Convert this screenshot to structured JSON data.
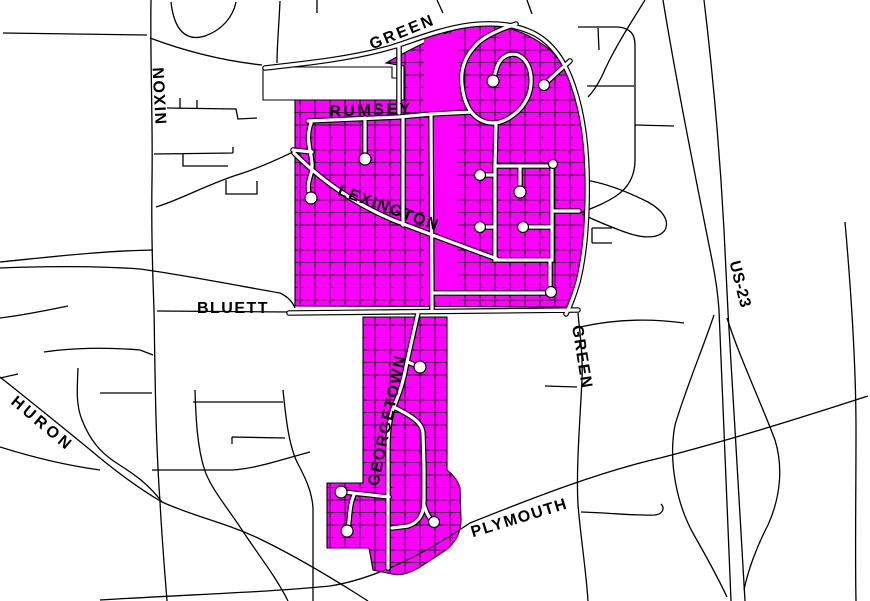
{
  "map": {
    "background_color": "#FFFFFF",
    "road_color": "#000000",
    "highlight_color": "#FF00FF",
    "street_fill_color": "#FFFFFF",
    "labels": [
      {
        "id": "green-top",
        "text": "GREEN"
      },
      {
        "id": "rumsey",
        "text": "RUMSEY"
      },
      {
        "id": "lexington",
        "text": "LEXINGTON"
      },
      {
        "id": "nixon",
        "text": "NIXON"
      },
      {
        "id": "bluett",
        "text": "BLUETT"
      },
      {
        "id": "georgetown",
        "text": "GEORGETOWN"
      },
      {
        "id": "huron",
        "text": "HURON"
      },
      {
        "id": "green-east",
        "text": "GREEN"
      },
      {
        "id": "plymouth",
        "text": "PLYMOUTH"
      },
      {
        "id": "us23",
        "text": "US-23"
      }
    ]
  }
}
